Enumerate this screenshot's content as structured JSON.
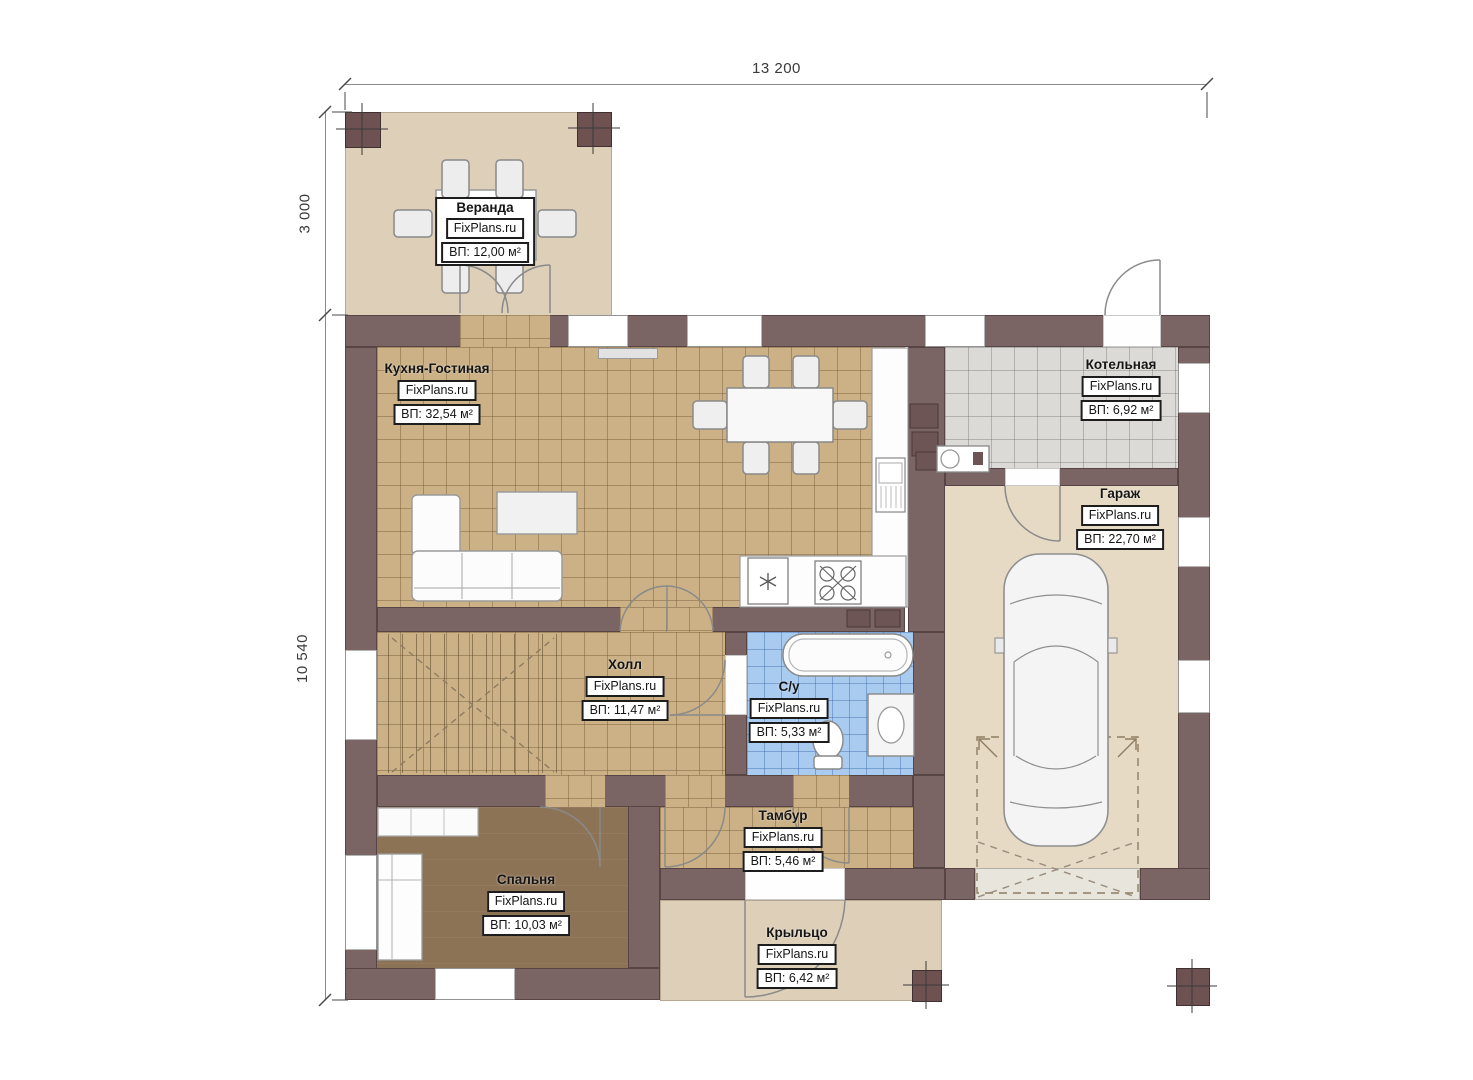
{
  "plan": {
    "site_watermark": "FixPlans.ru",
    "dimensions": {
      "top_width": "13 200",
      "veranda_depth": "3 000",
      "house_depth": "10 540"
    },
    "rooms": [
      {
        "id": "veranda",
        "name": "Веранда",
        "site": "FixPlans.ru",
        "area": "ВП: 12,00 м²"
      },
      {
        "id": "kitchen-living",
        "name": "Кухня-Гостиная",
        "site": "FixPlans.ru",
        "area": "ВП: 32,54 м²"
      },
      {
        "id": "boiler",
        "name": "Котельная",
        "site": "FixPlans.ru",
        "area": "ВП: 6,92 м²"
      },
      {
        "id": "garage",
        "name": "Гараж",
        "site": "FixPlans.ru",
        "area": "ВП: 22,70 м²"
      },
      {
        "id": "hall",
        "name": "Холл",
        "site": "FixPlans.ru",
        "area": "ВП: 11,47 м²"
      },
      {
        "id": "bathroom",
        "name": "С/у",
        "site": "FixPlans.ru",
        "area": "ВП: 5,33 м²"
      },
      {
        "id": "vestibule",
        "name": "Тамбур",
        "site": "FixPlans.ru",
        "area": "ВП: 5,46 м²"
      },
      {
        "id": "bedroom",
        "name": "Спальня",
        "site": "FixPlans.ru",
        "area": "ВП: 10,03 м²"
      },
      {
        "id": "porch",
        "name": "Крыльцо",
        "site": "FixPlans.ru",
        "area": "ВП: 6,42 м²"
      }
    ],
    "colors": {
      "wall": "#7a6464",
      "floor_tile_tan": "#cbb185",
      "floor_blue": "#a9cbf0",
      "floor_gray": "#dbdad6",
      "floor_bedroom": "#8d7355",
      "floor_veranda": "#ddcfb8",
      "floor_garage": "#e6dac5"
    }
  }
}
